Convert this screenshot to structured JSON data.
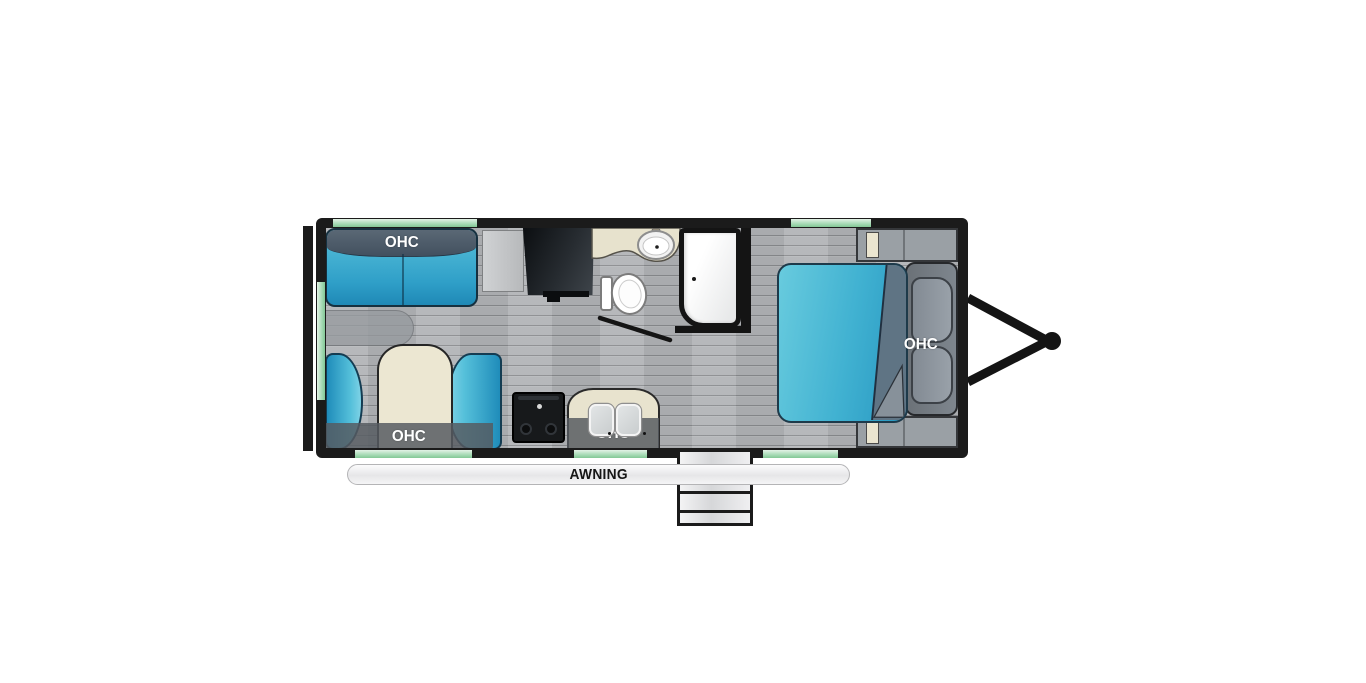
{
  "title": "travel-trailer-floorplan",
  "labels": {
    "sofa_ohc": "OHC",
    "dinette_ohc": "OHC",
    "kitchen_ohc": "OHC",
    "bed_ohc": "OHC",
    "awning": "AWNING"
  },
  "colors": {
    "wall": "#1b1b1b",
    "floor": "#b2b4b7",
    "window_green": "#9bd4ab",
    "upholstery_blue": "#2fa3c9",
    "upholstery_blue_light": "#5fc4da",
    "sofa_back_gray": "#4b5c6c",
    "table_tan": "#ece7d2",
    "counter_tan": "#e8e3ce",
    "ohc_band_gray": "#5a5e63",
    "cabinet_gray": "#9aa0a5",
    "headboard_gray": "#747c85",
    "appliance_black": "#17191b",
    "fixture_white": "#ffffff",
    "awning_bar": "#f2f2f3"
  },
  "elements": [
    "rear-bumper",
    "left-window",
    "top-windows",
    "bottom-windows",
    "sofa-with-ohc",
    "side-table",
    "dinette-with-table-and-ohc",
    "tv-on-cabinet",
    "range-stove",
    "kitchen-counter-double-sink-ohc",
    "bathroom-vanity-sink",
    "toilet",
    "shower",
    "bathroom-door",
    "queen-bed",
    "headboard-pillows-ohc",
    "wardrobe-cabinets",
    "entry-door-steps",
    "awning-rail",
    "a-frame-hitch"
  ]
}
